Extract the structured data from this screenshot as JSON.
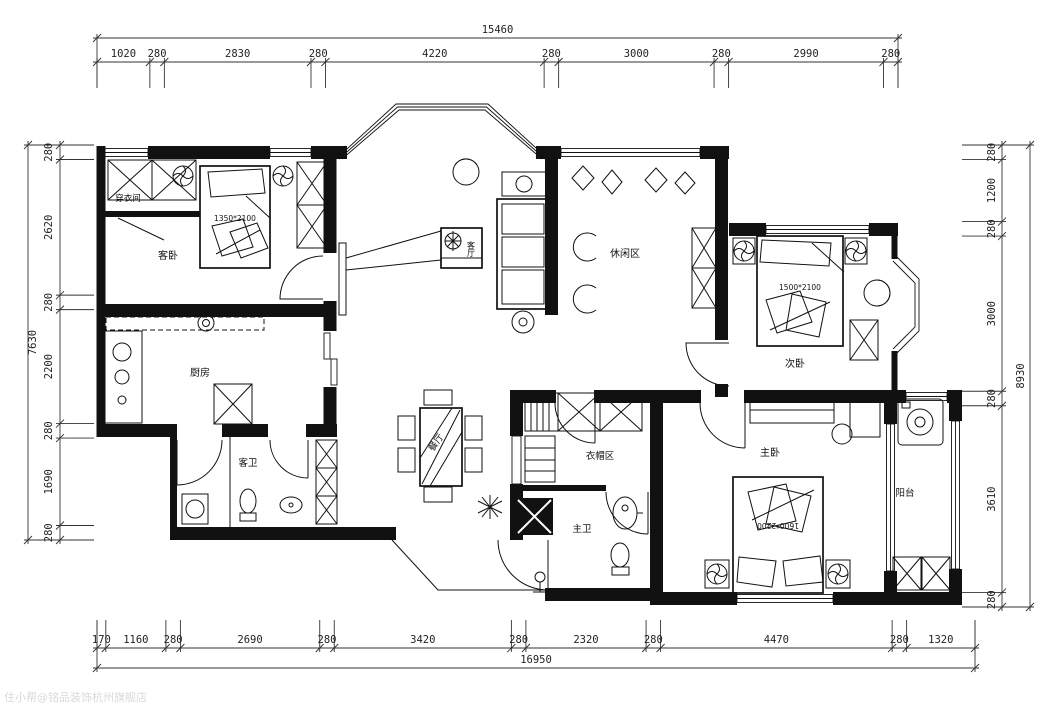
{
  "drawing": {
    "watermark": "住小帮@铭品装饰杭州旗舰店",
    "colors": {
      "line": "#111111",
      "background": "#ffffff",
      "watermark": "#d9d9d9"
    }
  },
  "rooms": {
    "guest_bedroom": "客卧",
    "dressing_room": "穿衣间",
    "kitchen": "厨房",
    "guest_bath": "客卫",
    "dining": "餐厅",
    "living": "客厅",
    "leisure": "休闲区",
    "second_bedroom": "次卧",
    "cloak_area": "衣帽区",
    "master_bath": "主卫",
    "master_bedroom": "主卧",
    "balcony": "阳台"
  },
  "furniture_labels": {
    "guest_bed_size": "1350*2100",
    "second_bed_size": "1500*2100",
    "master_bed_size": "1600*2200"
  },
  "dimensions": {
    "top": {
      "total": "15460",
      "segments": [
        "1020",
        "280",
        "2830",
        "280",
        "4220",
        "280",
        "3000",
        "280",
        "2990",
        "280"
      ]
    },
    "bottom": {
      "total": "16950",
      "segments": [
        "170",
        "1160",
        "280",
        "2690",
        "280",
        "3420",
        "280",
        "2320",
        "280",
        "4470",
        "280",
        "1320"
      ]
    },
    "left": {
      "total": "7630",
      "segments": [
        "280",
        "2620",
        "280",
        "2200",
        "280",
        "1690",
        "280"
      ]
    },
    "right": {
      "total": "8930",
      "segments": [
        "280",
        "1200",
        "280",
        "3000",
        "280",
        "3610",
        "280"
      ]
    }
  }
}
